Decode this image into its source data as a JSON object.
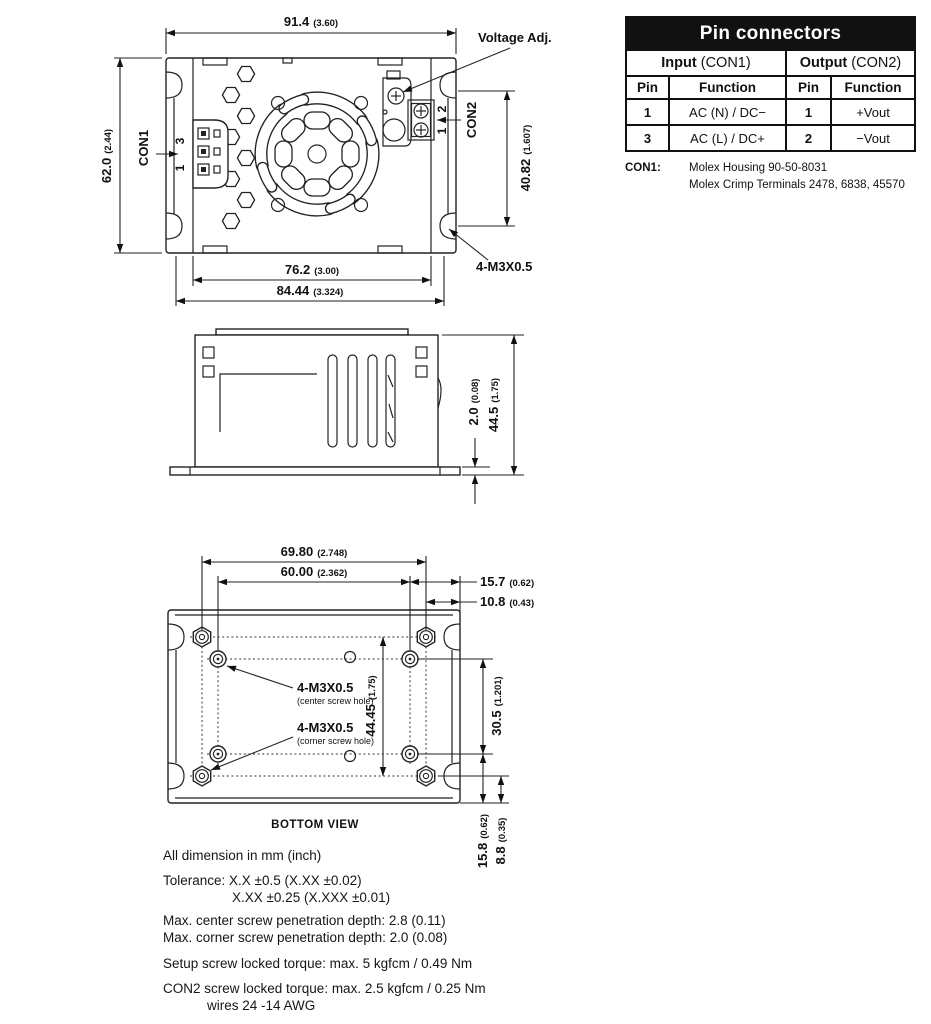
{
  "table": {
    "title": "Pin connectors",
    "groups": [
      {
        "bold": "Input",
        "rest": " (CON1)"
      },
      {
        "bold": "Output",
        "rest": " (CON2)"
      }
    ],
    "headers": {
      "pin": "Pin",
      "function": "Function"
    },
    "rows": [
      {
        "in_pin": "1",
        "in_fn": "AC (N) / DC−",
        "out_pin": "1",
        "out_fn": "+Vout"
      },
      {
        "in_pin": "3",
        "in_fn": "AC (L) / DC+",
        "out_pin": "2",
        "out_fn": "−Vout"
      }
    ],
    "footnote": {
      "label": "CON1:",
      "line1": "Molex Housing 90-50-8031",
      "line2": "Molex Crimp Terminals 2478, 6838, 45570"
    }
  },
  "top_view": {
    "dims": {
      "overall_width": {
        "mm": "91.4",
        "in": "(3.60)"
      },
      "overall_height": {
        "mm": "62.0",
        "in": "(2.44)"
      },
      "con2_offset": {
        "mm": "40.82",
        "in": "(1.607)"
      },
      "inner_width": {
        "mm": "76.2",
        "in": "(3.00)"
      },
      "flange_width": {
        "mm": "84.44",
        "in": "(3.324)"
      }
    },
    "labels": {
      "voltage_adj": "Voltage Adj.",
      "con1": "CON1",
      "con1_pin_top": "3",
      "con1_pin_bottom": "1",
      "con2": "CON2",
      "con2_pin_top": "2",
      "con2_pin_bottom": "1",
      "screws": "4-M3X0.5"
    }
  },
  "side_view": {
    "dims": {
      "flange_thickness": {
        "mm": "2.0",
        "in": "(0.08)"
      },
      "height": {
        "mm": "44.5",
        "in": "(1.75)"
      }
    }
  },
  "bottom_view": {
    "dims": {
      "hole_span_outer": {
        "mm": "69.80",
        "in": "(2.748)"
      },
      "hole_span_inner": {
        "mm": "60.00",
        "in": "(2.362)"
      },
      "edge_to_inner": {
        "mm": "15.7",
        "in": "(0.62)"
      },
      "edge_to_outer": {
        "mm": "10.8",
        "in": "(0.43)"
      },
      "vertical_outer": {
        "mm": "44.45",
        "in": "(1.75)"
      },
      "vertical_inner": {
        "mm": "30.5",
        "in": "(1.201)"
      },
      "bottom_inner": {
        "mm": "15.8",
        "in": "(0.62)"
      },
      "bottom_outer": {
        "mm": "8.8",
        "in": "(0.35)"
      }
    },
    "labels": {
      "center_screw": "4-M3X0.5",
      "center_screw_sub": "(center screw hole)",
      "corner_screw": "4-M3X0.5",
      "corner_screw_sub": "(corner screw hole)",
      "caption": "BOTTOM VIEW"
    }
  },
  "notes": {
    "units": "All dimension in mm (inch)",
    "tolerance1": "Tolerance: X.X ±0.5 (X.XX ±0.02)",
    "tolerance2": "X.XX ±0.25 (X.XXX ±0.01)",
    "center_depth": "Max. center screw penetration depth: 2.8 (0.11)",
    "corner_depth": "Max. corner screw penetration depth: 2.0 (0.08)",
    "setup_torque": "Setup screw locked torque: max. 5 kgfcm / 0.49 Nm",
    "con2_torque": "CON2 screw locked torque: max. 2.5 kgfcm / 0.25 Nm",
    "wires": "wires 24 -14 AWG"
  }
}
